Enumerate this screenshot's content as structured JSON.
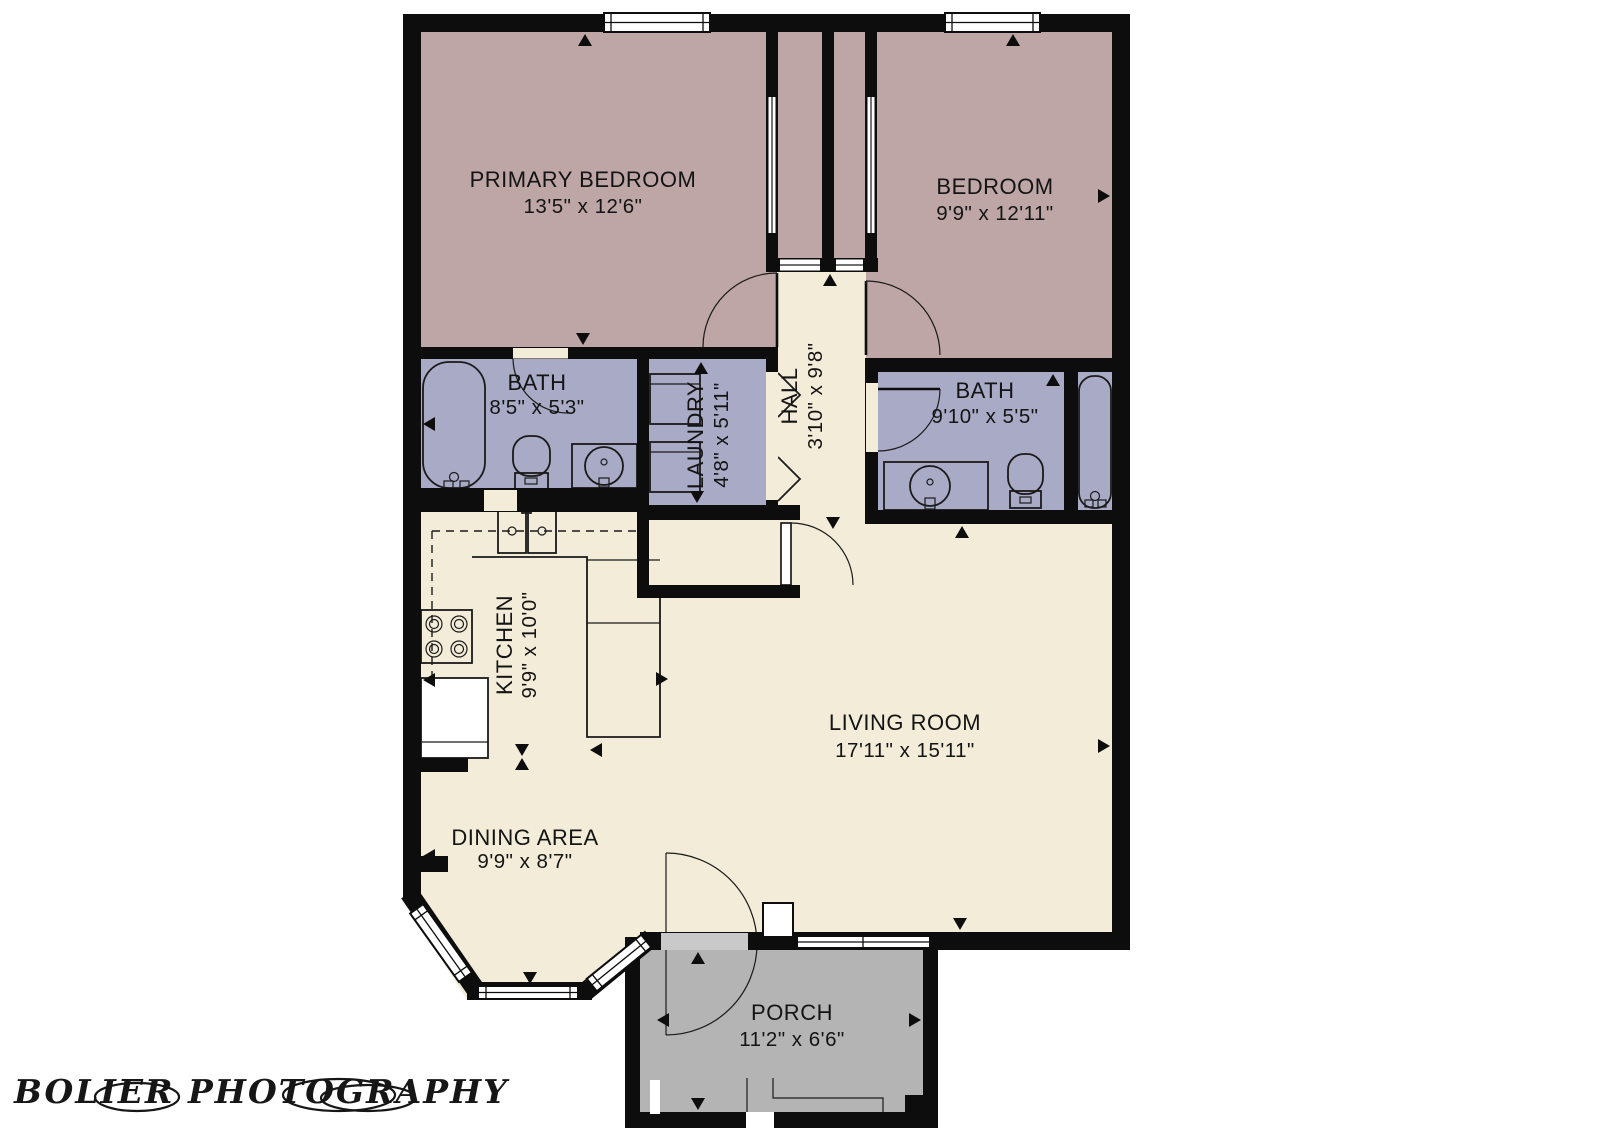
{
  "watermark": {
    "text": "BOLIER PHOTOGRAPHY"
  },
  "colors": {
    "floor": "#f2ecd8",
    "bedroom": "#bda6a5",
    "bathroom": "#a8aac6",
    "porch": "#b4b4b4",
    "wall": "#0d0d0d",
    "threshold": "#c9c9c9",
    "background": "#ffffff"
  },
  "rooms": {
    "primary_bedroom": {
      "name": "PRIMARY BEDROOM",
      "dims": "13'5\" x 12'6\""
    },
    "bedroom": {
      "name": "BEDROOM",
      "dims": "9'9\" x 12'11\""
    },
    "bath_left": {
      "name": "BATH",
      "dims": "8'5\" x 5'3\""
    },
    "laundry": {
      "name": "LAUNDRY",
      "dims": "4'8\" x 5'11\""
    },
    "hall": {
      "name": "HALL",
      "dims": "3'10\" x 9'8\""
    },
    "bath_right": {
      "name": "BATH",
      "dims": "9'10\" x 5'5\""
    },
    "kitchen": {
      "name": "KITCHEN",
      "dims": "9'9\" x 10'0\""
    },
    "living_room": {
      "name": "LIVING ROOM",
      "dims": "17'11\" x 15'11\""
    },
    "dining_area": {
      "name": "DINING AREA",
      "dims": "9'9\" x 8'7\""
    },
    "porch": {
      "name": "PORCH",
      "dims": "11'2\" x 6'6\""
    }
  },
  "fixtures": [
    "bathtub",
    "toilet",
    "vanity-sink",
    "washer",
    "dryer",
    "kitchen-sink",
    "stove",
    "refrigerator"
  ]
}
